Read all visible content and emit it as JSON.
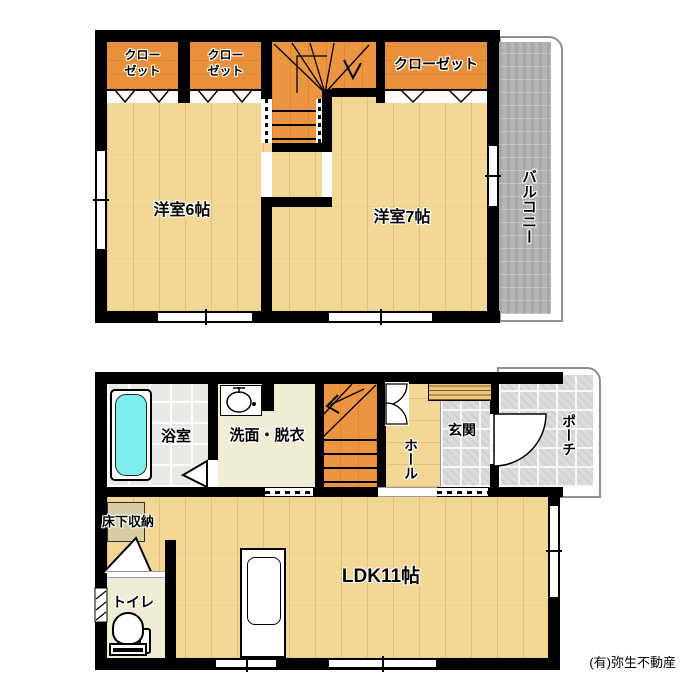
{
  "credit": "(有)弥生不動産",
  "colors": {
    "wall": "#000000",
    "wood_floor": "#F2D795",
    "stair_orange": "#EC9540",
    "closet_orange": "#E8913A",
    "balcony_gray": "#B4B4B4",
    "entry_tile_gray": "#DBDBDB",
    "bath_tile": "#E9E9E5",
    "cream_floor": "#EFEDD6",
    "bathtub_cyan": "#7EEDED"
  },
  "floor2": {
    "closet1": {
      "line1": "クロー",
      "line2": "ゼット"
    },
    "closet2": {
      "line1": "クロー",
      "line2": "ゼット"
    },
    "closet3": {
      "label": "クローゼット"
    },
    "room6": {
      "label": "洋室6帖"
    },
    "room7": {
      "label": "洋室7帖"
    },
    "balcony": {
      "label": "バルコニー"
    }
  },
  "floor1": {
    "bathroom": {
      "label": "浴室"
    },
    "washroom": {
      "label": "洗面・脱衣"
    },
    "hall": {
      "label": "ホール"
    },
    "entrance": {
      "label": "玄関"
    },
    "porch": {
      "label": "ポーチ"
    },
    "underfloor_storage": {
      "label": "床下収納"
    },
    "toilet": {
      "label": "トイレ"
    },
    "ldk": {
      "label": "LDK11帖"
    }
  }
}
